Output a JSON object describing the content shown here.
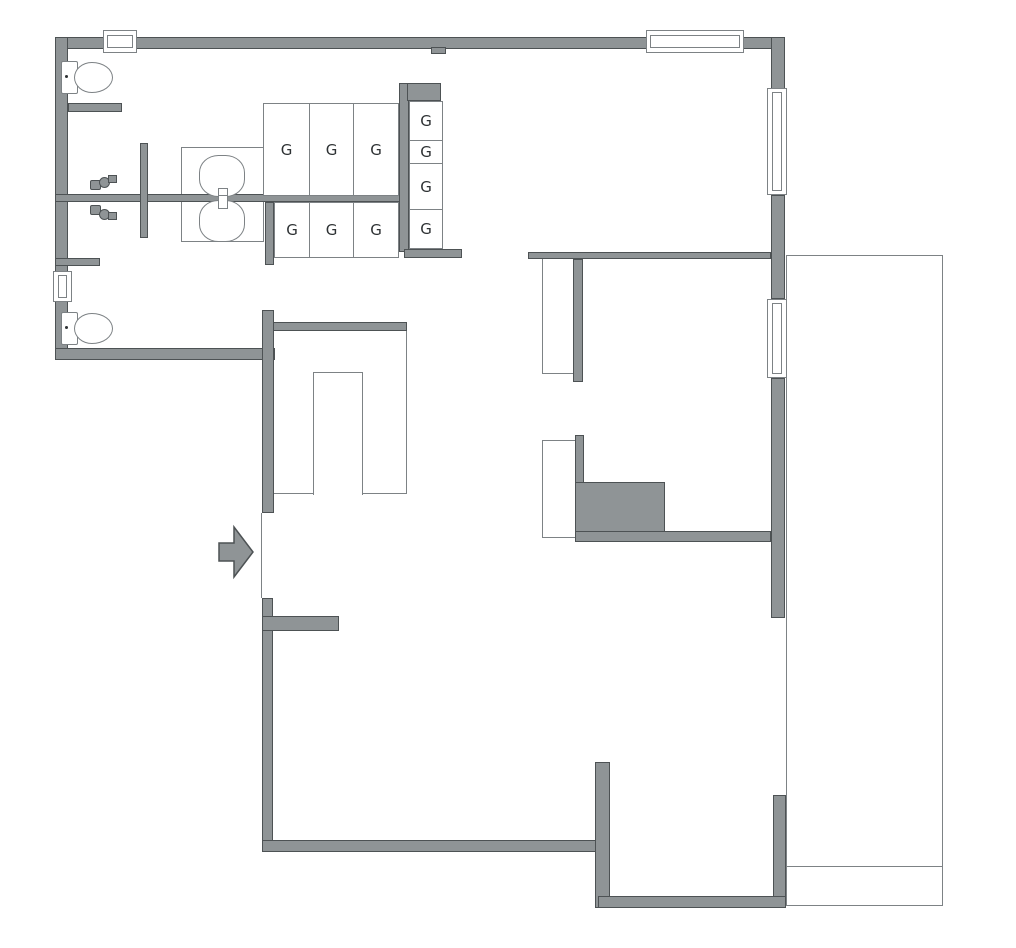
{
  "plan": {
    "type": "architectural-floor-plan",
    "locker_label": "G"
  },
  "colors": {
    "background": "#ffffff",
    "wall_fill": "#8f9496",
    "wall_edge": "#4d5254",
    "thin_line": "#7d8285",
    "label_text": "#2e3234"
  },
  "lockers": {
    "top_row": [
      "G",
      "G",
      "G"
    ],
    "bottom_row": [
      "G",
      "G",
      "G"
    ],
    "right_column": [
      "G",
      "G",
      "G",
      "G"
    ]
  }
}
